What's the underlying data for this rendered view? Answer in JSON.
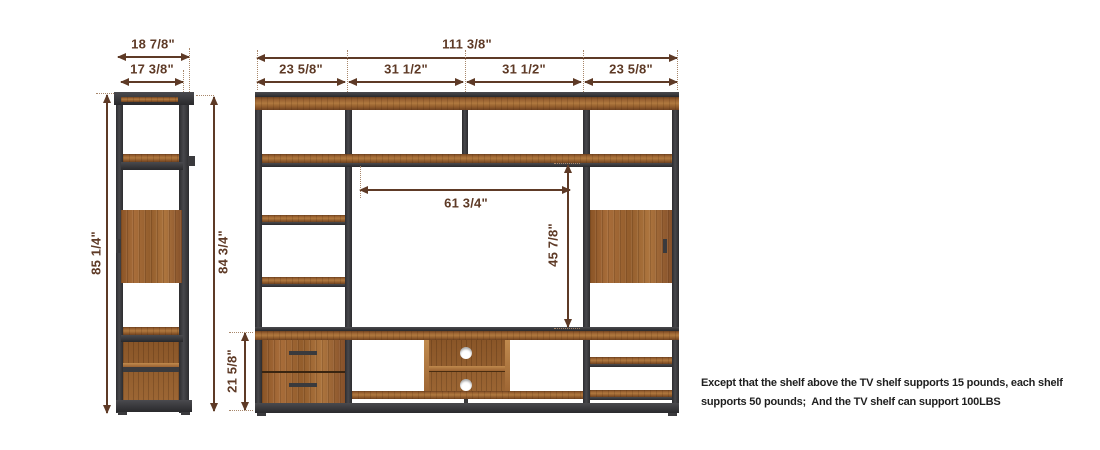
{
  "side_view": {
    "dim_top_outer": "18 7/8\"",
    "dim_top_inner": "17 3/8\"",
    "dim_height_left": "85 1/4\"",
    "dim_height_right": "84 3/4\""
  },
  "front_view": {
    "dim_total_width": "111 3/8\"",
    "dim_sections": [
      "23 5/8\"",
      "31 1/2\"",
      "31 1/2\"",
      "23 5/8\""
    ],
    "dim_tv_opening_width": "61 3/4\"",
    "dim_tv_opening_height": "45 7/8\"",
    "dim_console_height": "21 5/8\""
  },
  "note_lines": [
    "Except that the shelf above the TV shelf supports 15 pounds, each shelf",
    "supports 50 pounds;  And the TV shelf can support 100LBS"
  ],
  "colors": {
    "dimension": "#5e3a26",
    "metal_frame": "#3a3a3d",
    "wood": "#9c6331",
    "note_text": "#1f1f1f",
    "background": "#ffffff"
  }
}
